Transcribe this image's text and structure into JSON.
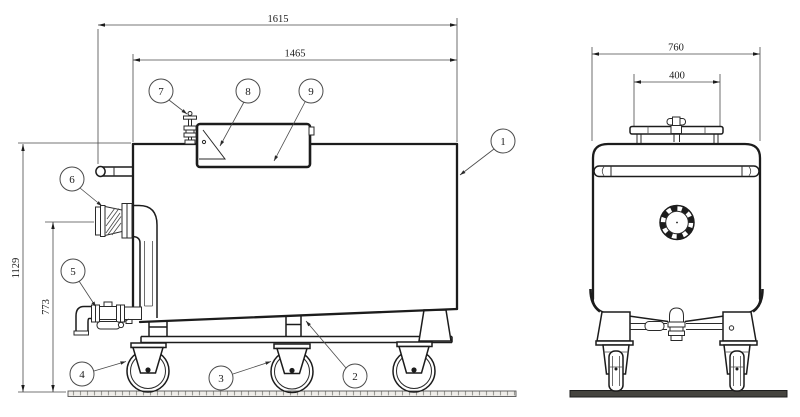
{
  "colors": {
    "line": "#1c1c1c",
    "background": "#ffffff",
    "ground_fill": "#efede9"
  },
  "side_view": {
    "dims": {
      "overall_length": "1615",
      "tank_length": "1465",
      "overall_height": "1129",
      "outlet_height": "773"
    }
  },
  "front_view": {
    "dims": {
      "overall_width": "760",
      "manhole_width": "400"
    }
  },
  "callouts": {
    "c1": "1",
    "c2": "2",
    "c3": "3",
    "c4": "4",
    "c5": "5",
    "c6": "6",
    "c7": "7",
    "c8": "8",
    "c9": "9"
  }
}
